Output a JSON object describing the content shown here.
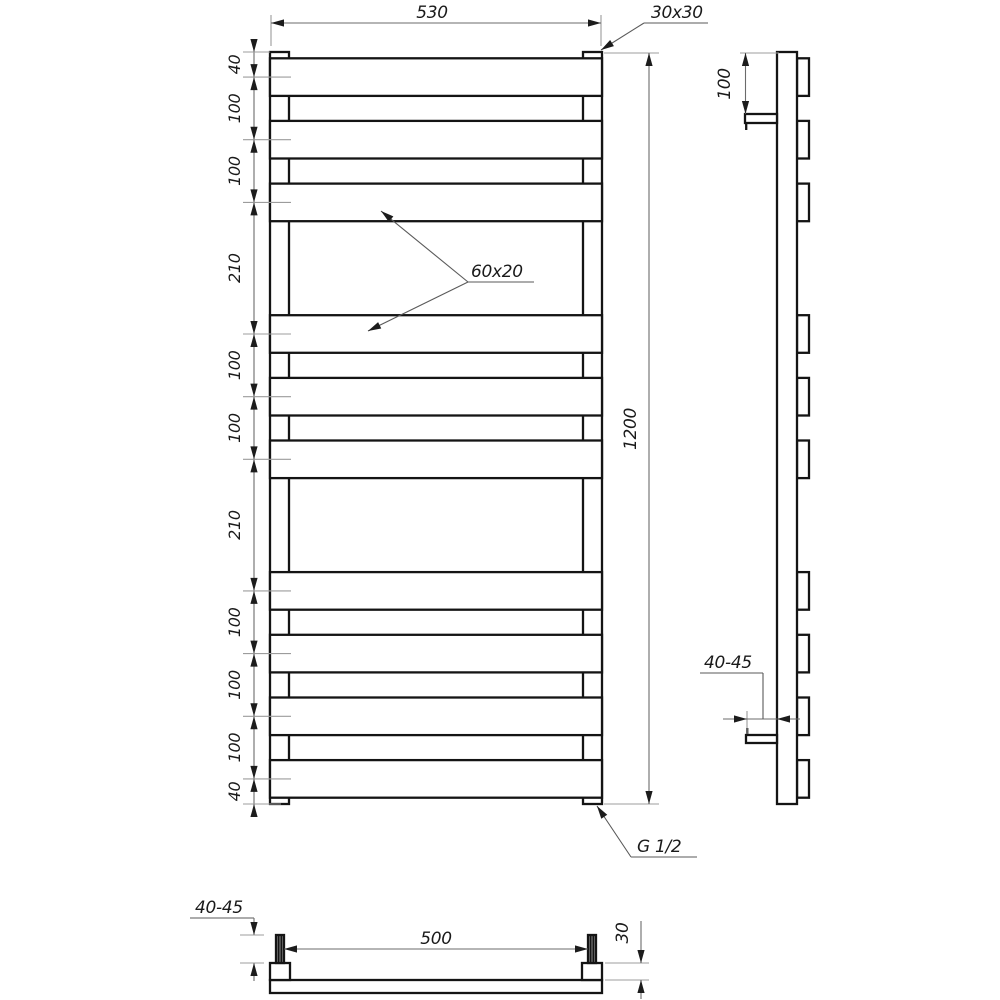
{
  "drawing": {
    "background_color": "#ffffff",
    "line_color": "#141414",
    "front_view": {
      "width_label": "530",
      "height_label": "1200",
      "collector_label": "30x30",
      "bar_label": "60x20",
      "connection_label": "G 1/2",
      "spacing_chain": [
        "40",
        "100",
        "100",
        "210",
        "100",
        "100",
        "210",
        "100",
        "100",
        "100",
        "40"
      ]
    },
    "side_view": {
      "bracket_offset_label": "100",
      "wall_distance_label": "40-45"
    },
    "bottom_view": {
      "wall_distance_label": "40-45",
      "mount_span_label": "500",
      "depth_label": "30"
    }
  }
}
